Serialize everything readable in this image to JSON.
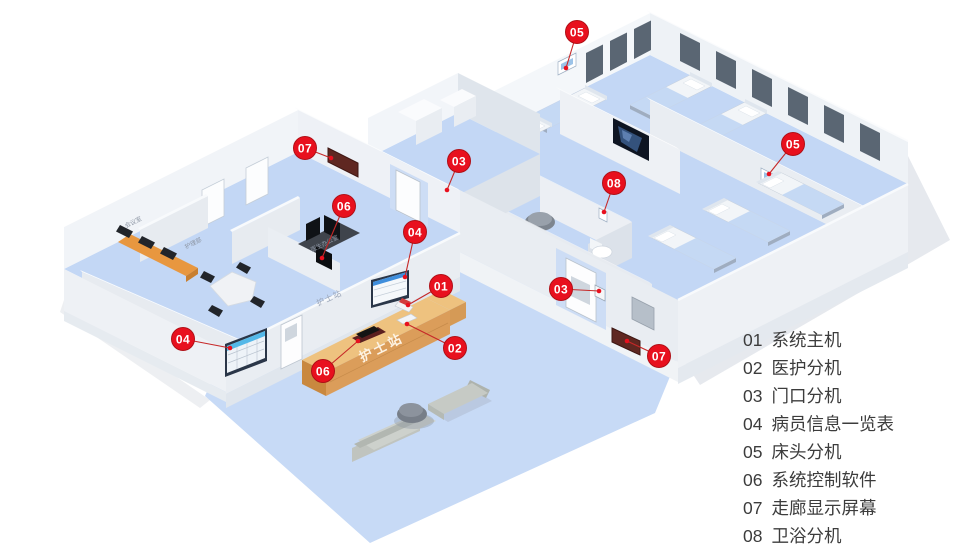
{
  "legend": {
    "items": [
      {
        "num": "01",
        "label": "系统主机"
      },
      {
        "num": "02",
        "label": "医护分机"
      },
      {
        "num": "03",
        "label": "门口分机"
      },
      {
        "num": "04",
        "label": "病员信息一览表"
      },
      {
        "num": "05",
        "label": "床头分机"
      },
      {
        "num": "06",
        "label": "系统控制软件"
      },
      {
        "num": "07",
        "label": "走廊显示屏幕"
      },
      {
        "num": "08",
        "label": "卫浴分机"
      }
    ]
  },
  "callouts": [
    {
      "num": "05",
      "x": 577,
      "y": 32,
      "tx": 566,
      "ty": 68
    },
    {
      "num": "07",
      "x": 305,
      "y": 148,
      "tx": 331,
      "ty": 158
    },
    {
      "num": "03",
      "x": 459,
      "y": 161,
      "tx": 447,
      "ty": 190
    },
    {
      "num": "08",
      "x": 614,
      "y": 183,
      "tx": 604,
      "ty": 212
    },
    {
      "num": "06",
      "x": 344,
      "y": 206,
      "tx": 322,
      "ty": 258
    },
    {
      "num": "04",
      "x": 415,
      "y": 232,
      "tx": 405,
      "ty": 277
    },
    {
      "num": "05",
      "x": 793,
      "y": 144,
      "tx": 769,
      "ty": 174
    },
    {
      "num": "01",
      "x": 441,
      "y": 286,
      "tx": 408,
      "ty": 305
    },
    {
      "num": "03",
      "x": 561,
      "y": 289,
      "tx": 599,
      "ty": 291
    },
    {
      "num": "04",
      "x": 183,
      "y": 339,
      "tx": 230,
      "ty": 348
    },
    {
      "num": "02",
      "x": 455,
      "y": 348,
      "tx": 407,
      "ty": 324
    },
    {
      "num": "06",
      "x": 323,
      "y": 371,
      "tx": 358,
      "ty": 341
    },
    {
      "num": "07",
      "x": 659,
      "y": 356,
      "tx": 627,
      "ty": 341
    }
  ],
  "floorplan_labels": {
    "nurse_station_wall": "护士站",
    "nurse_station_counter": "护士站",
    "room1": "会议室",
    "room2": "护理部",
    "room3": "医生办公室"
  },
  "colors": {
    "callout_red": "#e8101e",
    "floor_blue": "#c7daf6",
    "wall_white": "#eef1f5",
    "wood": "#db9d5a",
    "display_dark_red": "#5f2721"
  }
}
